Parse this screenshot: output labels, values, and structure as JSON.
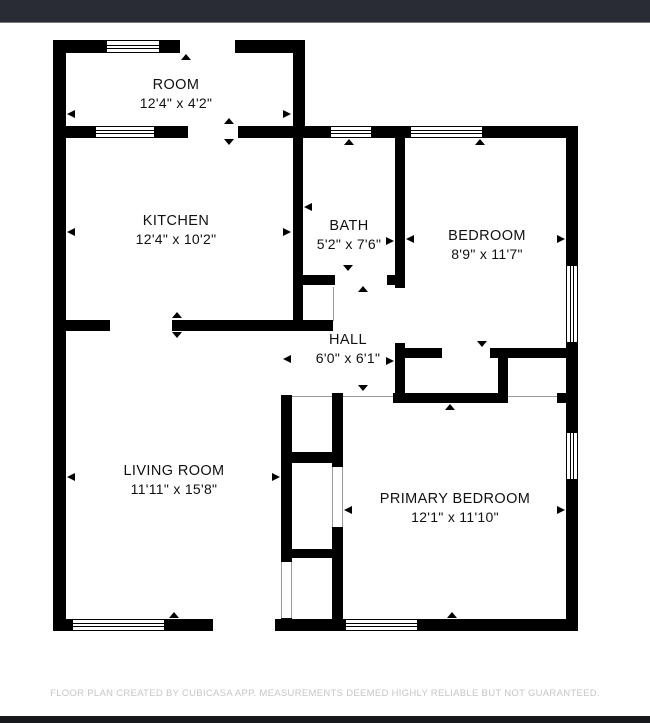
{
  "header": {
    "bar_color": "#2a2c33"
  },
  "footer": {
    "disclaimer": "FLOOR PLAN CREATED BY CUBICASA APP. MEASUREMENTS DEEMED HIGHLY RELIABLE BUT NOT GUARANTEED.",
    "bar_color": "#17181c",
    "text_color": "#c6c6c6"
  },
  "floorplan": {
    "wall_color": "#000000",
    "rooms": [
      {
        "id": "room",
        "name": "ROOM",
        "dims": "12'4\" x 4'2\"",
        "cx": 176,
        "top": 77
      },
      {
        "id": "kitchen",
        "name": "KITCHEN",
        "dims": "12'4\" x 10'2\"",
        "cx": 176,
        "top": 213
      },
      {
        "id": "bath",
        "name": "BATH",
        "dims": "5'2\" x 7'6\"",
        "cx": 349,
        "top": 218
      },
      {
        "id": "bedroom",
        "name": "BEDROOM",
        "dims": "8'9\" x 11'7\"",
        "cx": 487,
        "top": 228
      },
      {
        "id": "hall",
        "name": "HALL",
        "dims": "6'0\" x 6'1\"",
        "cx": 348,
        "top": 332
      },
      {
        "id": "living",
        "name": "LIVING ROOM",
        "dims": "11'11\" x 15'8\"",
        "cx": 174,
        "top": 463
      },
      {
        "id": "primary",
        "name": "PRIMARY BEDROOM",
        "dims": "12'1\" x 11'10\"",
        "cx": 455,
        "top": 491
      }
    ],
    "walls": [
      [
        53,
        40,
        13,
        591
      ],
      [
        53,
        40,
        53,
        13
      ],
      [
        160,
        40,
        20,
        13
      ],
      [
        235,
        40,
        70,
        13
      ],
      [
        53,
        126,
        42,
        12
      ],
      [
        155,
        126,
        33,
        12
      ],
      [
        238,
        126,
        92,
        12
      ],
      [
        372,
        126,
        38,
        12
      ],
      [
        483,
        126,
        95,
        12
      ],
      [
        566,
        126,
        12,
        139
      ],
      [
        566,
        343,
        12,
        89
      ],
      [
        566,
        480,
        12,
        151
      ],
      [
        53,
        619,
        19,
        12
      ],
      [
        165,
        619,
        48,
        12
      ],
      [
        275,
        619,
        70,
        12
      ],
      [
        418,
        619,
        160,
        12
      ],
      [
        293,
        40,
        12,
        98
      ],
      [
        293,
        138,
        10,
        193
      ],
      [
        66,
        320,
        44,
        11
      ],
      [
        172,
        320,
        161,
        11
      ],
      [
        303,
        275,
        32,
        10
      ],
      [
        387,
        275,
        18,
        10
      ],
      [
        395,
        138,
        10,
        150
      ],
      [
        395,
        343,
        10,
        60
      ],
      [
        405,
        348,
        37,
        10
      ],
      [
        490,
        348,
        88,
        10
      ],
      [
        498,
        348,
        10,
        55
      ],
      [
        393,
        393,
        115,
        10
      ],
      [
        557,
        393,
        21,
        10
      ],
      [
        281,
        395,
        11,
        167
      ],
      [
        281,
        618,
        11,
        13
      ],
      [
        332,
        393,
        11,
        74
      ],
      [
        332,
        527,
        11,
        92
      ],
      [
        281,
        452,
        62,
        11
      ],
      [
        281,
        549,
        62,
        9
      ]
    ],
    "windows": [
      {
        "x": 106,
        "y": 40,
        "w": 54,
        "h": 13,
        "o": "h"
      },
      {
        "x": 95,
        "y": 126,
        "w": 60,
        "h": 12,
        "o": "h"
      },
      {
        "x": 330,
        "y": 126,
        "w": 42,
        "h": 12,
        "o": "h"
      },
      {
        "x": 410,
        "y": 126,
        "w": 73,
        "h": 12,
        "o": "h"
      },
      {
        "x": 566,
        "y": 265,
        "w": 12,
        "h": 78,
        "o": "v"
      },
      {
        "x": 566,
        "y": 432,
        "w": 12,
        "h": 48,
        "o": "v"
      },
      {
        "x": 72,
        "y": 619,
        "w": 93,
        "h": 12,
        "o": "h"
      },
      {
        "x": 345,
        "y": 619,
        "w": 73,
        "h": 12,
        "o": "h"
      }
    ],
    "thin_lines": [
      [
        292,
        396,
        40,
        1
      ],
      [
        343,
        396,
        50,
        1
      ],
      [
        508,
        396,
        49,
        1
      ],
      [
        333,
        287,
        1,
        34
      ],
      [
        332,
        467,
        1,
        60
      ],
      [
        342,
        467,
        1,
        60
      ],
      [
        281,
        562,
        1,
        56
      ],
      [
        291,
        562,
        1,
        56
      ]
    ],
    "dim_arrows": [
      {
        "dir": "left",
        "x": 67,
        "y": 114
      },
      {
        "dir": "right",
        "x": 291,
        "y": 114
      },
      {
        "dir": "left",
        "x": 67,
        "y": 232
      },
      {
        "dir": "right",
        "x": 291,
        "y": 232
      },
      {
        "dir": "left",
        "x": 304,
        "y": 207
      },
      {
        "dir": "right",
        "x": 394,
        "y": 241
      },
      {
        "dir": "left",
        "x": 406,
        "y": 239
      },
      {
        "dir": "right",
        "x": 565,
        "y": 239
      },
      {
        "dir": "left",
        "x": 283,
        "y": 359
      },
      {
        "dir": "right",
        "x": 394,
        "y": 361
      },
      {
        "dir": "left",
        "x": 67,
        "y": 477
      },
      {
        "dir": "right",
        "x": 280,
        "y": 477
      },
      {
        "dir": "left",
        "x": 344,
        "y": 510
      },
      {
        "dir": "right",
        "x": 565,
        "y": 510
      }
    ],
    "opening_markers": [
      {
        "dir": "up",
        "x": 186,
        "y": 54
      },
      {
        "dir": "up",
        "x": 229,
        "y": 118
      },
      {
        "dir": "down",
        "x": 229,
        "y": 139
      },
      {
        "dir": "up",
        "x": 349,
        "y": 139
      },
      {
        "dir": "up",
        "x": 480,
        "y": 139
      },
      {
        "dir": "down",
        "x": 348,
        "y": 265
      },
      {
        "dir": "up",
        "x": 363,
        "y": 286
      },
      {
        "dir": "down",
        "x": 482,
        "y": 341
      },
      {
        "dir": "up",
        "x": 450,
        "y": 404
      },
      {
        "dir": "down",
        "x": 363,
        "y": 385
      },
      {
        "dir": "up",
        "x": 177,
        "y": 312
      },
      {
        "dir": "down",
        "x": 177,
        "y": 332
      },
      {
        "dir": "up",
        "x": 174,
        "y": 612
      },
      {
        "dir": "up",
        "x": 452,
        "y": 612
      }
    ]
  }
}
